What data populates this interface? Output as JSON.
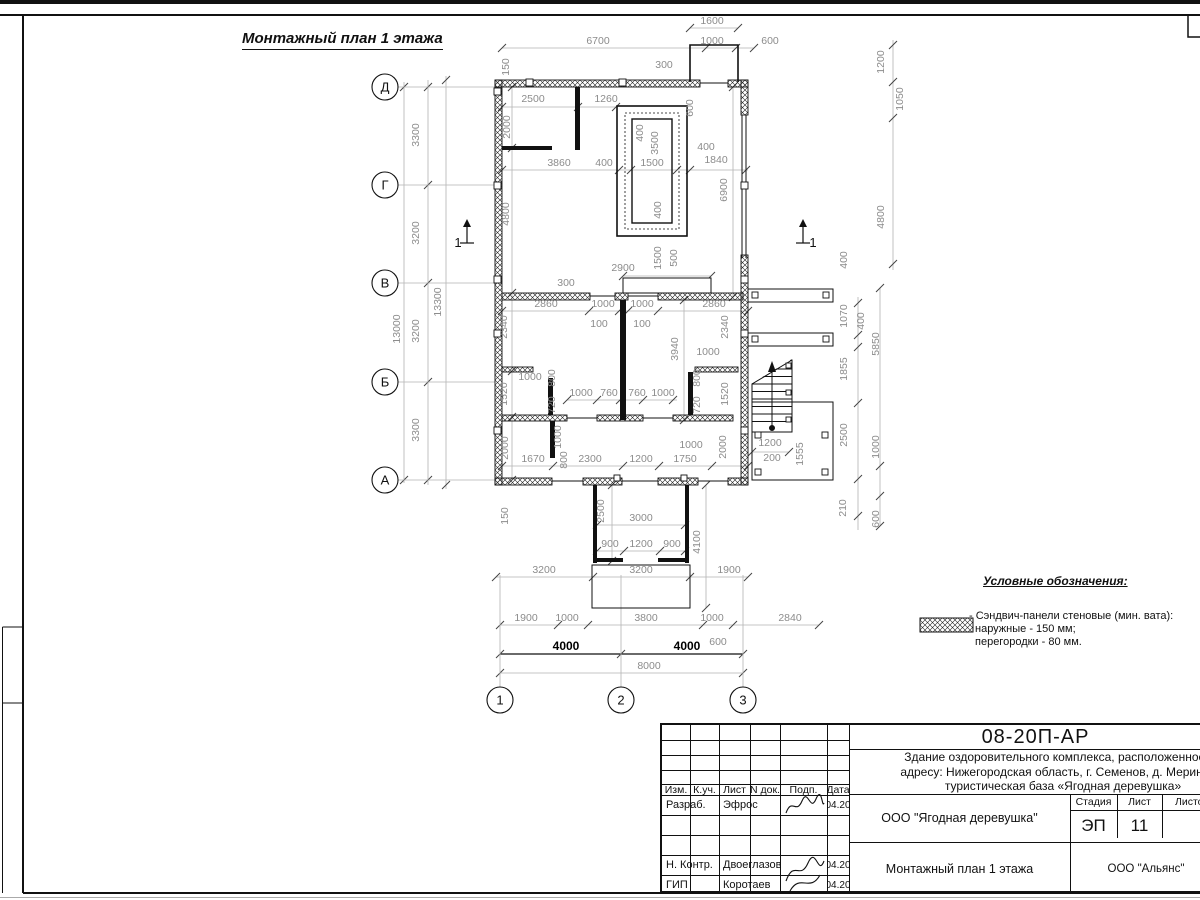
{
  "page": {
    "title": "Монтажный план 1 этажа"
  },
  "legend": {
    "title": "Условные обозначения:",
    "item_line1": "- Сэндвич-панели стеновые (мин. вата):",
    "item_line2": "наружные - 150 мм;",
    "item_line3": "перегородки - 80 мм."
  },
  "stamp": {
    "doc_number": "08-20П-АР",
    "desc1": "Здание оздоровительного комплекса, расположенное по",
    "desc2": "адресу: Нижегородская область, г. Семенов, д. Мериново,",
    "desc3": "туристическая база «Ягодная деревушка»",
    "hdr": {
      "izm": "Изм.",
      "kuch": "К.уч.",
      "list": "Лист",
      "ndok": "N док.",
      "podp": "Подп.",
      "data": "Дата"
    },
    "rows": [
      {
        "role": "Разраб.",
        "name": "Эфрос",
        "date": "04.20"
      },
      {
        "role": "",
        "name": "",
        "date": ""
      },
      {
        "role": "",
        "name": "",
        "date": ""
      },
      {
        "role": "Н. Контр.",
        "name": "Двоеглазов",
        "date": "04.20"
      },
      {
        "role": "ГИП",
        "name": "Коротаев",
        "date": "04.20"
      }
    ],
    "org": "ООО \"Ягодная деревушка\"",
    "stage_label": "Стадия",
    "sheet_label": "Лист",
    "sheets_label": "Листов",
    "stage": "ЭП",
    "sheet_no": "11",
    "sheets_total": "",
    "drawing_title": "Монтажный план 1 этажа",
    "company": "ООО \"Альянс\""
  },
  "colors": {
    "dim_text": "#8c8c8c",
    "dim_line": "#b3b3b3",
    "tick": "#444",
    "ink": "#111"
  },
  "plan": {
    "axes_rows": [
      [
        "Д",
        87
      ],
      [
        "Г",
        185
      ],
      [
        "В",
        283
      ],
      [
        "Б",
        382
      ],
      [
        "А",
        480
      ]
    ],
    "axes_cols": [
      [
        "1",
        500
      ],
      [
        "2",
        621
      ],
      [
        "3",
        743
      ]
    ],
    "sections": [
      [
        467,
        233,
        "1",
        "l"
      ],
      [
        803,
        233,
        "1",
        "r"
      ]
    ],
    "labels": [
      [
        "1600",
        712,
        24
      ],
      [
        "6700",
        598,
        44
      ],
      [
        "1000",
        712,
        44
      ],
      [
        "600",
        770,
        44
      ],
      [
        "300",
        664,
        68
      ],
      [
        "150",
        509,
        67,
        "r"
      ],
      [
        "2500",
        533,
        102
      ],
      [
        "1260",
        606,
        102
      ],
      [
        "600",
        693,
        108,
        "r"
      ],
      [
        "2000",
        510,
        127,
        "r"
      ],
      [
        "400",
        643,
        133,
        "r"
      ],
      [
        "3500",
        658,
        143,
        "r"
      ],
      [
        "3860",
        559,
        166
      ],
      [
        "400",
        604,
        166
      ],
      [
        "1500",
        652,
        166
      ],
      [
        "400",
        706,
        150
      ],
      [
        "1840",
        716,
        163
      ],
      [
        "1200",
        884,
        62,
        "r"
      ],
      [
        "1050",
        903,
        99,
        "r"
      ],
      [
        "6900",
        727,
        190,
        "r"
      ],
      [
        "4800",
        509,
        214,
        "r"
      ],
      [
        "4800",
        884,
        217,
        "r"
      ],
      [
        "400",
        661,
        210,
        "r"
      ],
      [
        "1500",
        661,
        258,
        "r"
      ],
      [
        "500",
        677,
        258,
        "r"
      ],
      [
        "2900",
        623,
        271
      ],
      [
        "300",
        566,
        286
      ],
      [
        "400",
        847,
        260,
        "r"
      ],
      [
        "2860",
        546,
        307
      ],
      [
        "1000",
        603,
        307
      ],
      [
        "1000",
        642,
        307
      ],
      [
        "2860",
        714,
        307
      ],
      [
        "100",
        599,
        327
      ],
      [
        "100",
        642,
        327
      ],
      [
        "2340",
        507,
        327,
        "r"
      ],
      [
        "2340",
        728,
        327,
        "r"
      ],
      [
        "3940",
        678,
        349,
        "r"
      ],
      [
        "1000",
        708,
        355
      ],
      [
        "1070",
        847,
        316,
        "r"
      ],
      [
        "400",
        864,
        321,
        "r"
      ],
      [
        "5850",
        879,
        344,
        "r"
      ],
      [
        "1000",
        530,
        380
      ],
      [
        "800",
        555,
        378,
        "r"
      ],
      [
        "720",
        555,
        405,
        "r"
      ],
      [
        "1520",
        507,
        394,
        "r"
      ],
      [
        "800",
        700,
        378,
        "r"
      ],
      [
        "720",
        700,
        405,
        "r"
      ],
      [
        "1520",
        728,
        394,
        "r"
      ],
      [
        "1000",
        581,
        396
      ],
      [
        "760",
        609,
        396
      ],
      [
        "760",
        637,
        396
      ],
      [
        "1000",
        663,
        396
      ],
      [
        "1855",
        847,
        369,
        "r"
      ],
      [
        "2500",
        847,
        435,
        "r"
      ],
      [
        "1000",
        879,
        447,
        "r"
      ],
      [
        "1555",
        803,
        454,
        "r"
      ],
      [
        "2000",
        508,
        448,
        "r"
      ],
      [
        "1000",
        561,
        437,
        "r"
      ],
      [
        "800",
        567,
        460,
        "r"
      ],
      [
        "1670",
        533,
        462
      ],
      [
        "2300",
        590,
        462
      ],
      [
        "1200",
        641,
        462
      ],
      [
        "1750",
        685,
        462
      ],
      [
        "1000",
        691,
        448
      ],
      [
        "2000",
        726,
        447,
        "r"
      ],
      [
        "1200",
        770,
        446
      ],
      [
        "200",
        772,
        461
      ],
      [
        "150",
        508,
        516,
        "r"
      ],
      [
        "2500",
        604,
        511,
        "r"
      ],
      [
        "3000",
        641,
        521
      ],
      [
        "900",
        610,
        547
      ],
      [
        "1200",
        641,
        547
      ],
      [
        "900",
        672,
        547
      ],
      [
        "4100",
        700,
        542,
        "r"
      ],
      [
        "210",
        846,
        508,
        "r"
      ],
      [
        "600",
        879,
        519,
        "r"
      ],
      [
        "3200",
        544,
        573
      ],
      [
        "3200",
        641,
        573
      ],
      [
        "1900",
        729,
        573
      ],
      [
        "1900",
        526,
        621
      ],
      [
        "1000",
        567,
        621
      ],
      [
        "3800",
        646,
        621
      ],
      [
        "1000",
        712,
        621
      ],
      [
        "2840",
        790,
        621
      ],
      [
        "600",
        718,
        645
      ],
      [
        "4000",
        566,
        650,
        "b"
      ],
      [
        "4000",
        687,
        650,
        "b"
      ],
      [
        "8000",
        649,
        669
      ],
      [
        "3300",
        419,
        135,
        "r"
      ],
      [
        "3200",
        419,
        233,
        "r"
      ],
      [
        "3200",
        419,
        331,
        "r"
      ],
      [
        "3300",
        419,
        430,
        "r"
      ],
      [
        "13000",
        400,
        329,
        "r"
      ],
      [
        "13300",
        441,
        302,
        "r"
      ]
    ],
    "dim_lines": [
      [
        "h",
        28,
        690,
        738,
        [
          690,
          738
        ]
      ],
      [
        "h",
        48,
        502,
        754,
        [
          502,
          706,
          736,
          754
        ]
      ],
      [
        "h",
        107,
        502,
        617,
        [
          502,
          578,
          616
        ]
      ],
      [
        "h",
        170,
        502,
        748,
        [
          502,
          619,
          631,
          677,
          690,
          746
        ]
      ],
      [
        "h",
        276,
        623,
        711,
        [
          623,
          711
        ]
      ],
      [
        "h",
        311,
        502,
        748,
        [
          502,
          589,
          619,
          628,
          658,
          748
        ]
      ],
      [
        "h",
        400,
        567,
        677,
        [
          567,
          597,
          620,
          643,
          673
        ]
      ],
      [
        "h",
        452,
        752,
        789,
        [
          752,
          789
        ]
      ],
      [
        "h",
        466,
        502,
        748,
        [
          502,
          553,
          623,
          659,
          712,
          748
        ]
      ],
      [
        "h",
        525,
        597,
        685,
        [
          597,
          685
        ]
      ],
      [
        "h",
        551,
        597,
        685,
        [
          597,
          624,
          660,
          685
        ]
      ],
      [
        "h",
        577,
        496,
        748,
        [
          496,
          593,
          690,
          748
        ]
      ],
      [
        "h",
        625,
        500,
        819,
        [
          500,
          558,
          588,
          703,
          733,
          819
        ]
      ],
      [
        "h",
        654,
        500,
        743,
        [
          500,
          621,
          743
        ],
        "b"
      ],
      [
        "h",
        673,
        500,
        743,
        [
          500,
          743
        ]
      ],
      [
        "v",
        428,
        80,
        485,
        [
          87,
          185,
          283,
          382,
          480
        ]
      ],
      [
        "v",
        404,
        82,
        483,
        [
          87,
          480
        ]
      ],
      [
        "v",
        446,
        76,
        489,
        [
          80,
          485
        ]
      ],
      [
        "v",
        893,
        40,
        270,
        [
          45,
          82,
          118,
          264
        ]
      ],
      [
        "v",
        733,
        87,
        297,
        [
          87,
          297
        ]
      ],
      [
        "v",
        858,
        297,
        530,
        [
          303,
          335,
          347,
          403,
          479,
          516
        ]
      ],
      [
        "v",
        880,
        288,
        526,
        [
          288,
          466,
          496,
          526
        ]
      ],
      [
        "v",
        706,
        485,
        608,
        [
          485,
          608
        ]
      ],
      [
        "v",
        612,
        485,
        561,
        [
          485,
          561
        ]
      ],
      [
        "v",
        684,
        300,
        420,
        [
          300,
          420
        ]
      ],
      [
        "v",
        512,
        87,
        480,
        [
          87,
          148,
          293,
          371,
          417,
          480
        ]
      ]
    ]
  }
}
